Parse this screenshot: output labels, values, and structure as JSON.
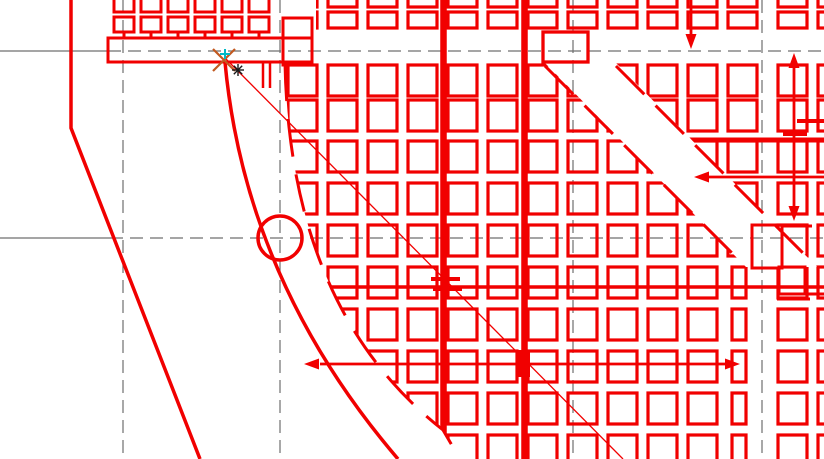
{
  "canvas": {
    "width": 824,
    "height": 459,
    "background": "#ffffff"
  },
  "colors": {
    "line_red": "#f10000",
    "construction_gray": "#6f6f6f",
    "snap_marker_orange": "#c2591f",
    "snap_cross_cyan": "#00b9c6",
    "point_marker_black": "#1a1a1a"
  },
  "construction_lines": {
    "dash": "13 7",
    "width": 1.2,
    "horizontal": [
      {
        "y": 51,
        "solid_from": 0,
        "solid_to": 108
      },
      {
        "y": 238,
        "solid_from": 0,
        "solid_to": 110
      }
    ],
    "vertical": [
      {
        "x": 123
      },
      {
        "x": 280
      },
      {
        "x": 573
      },
      {
        "x": 762
      }
    ]
  },
  "grid": {
    "stroke_width": 3.2,
    "cols_x": [
      288,
      328,
      368,
      408,
      448,
      488,
      528,
      568,
      608,
      648,
      688,
      728,
      778,
      818
    ],
    "rows_y": [
      65,
      100,
      141,
      183,
      225,
      267,
      309,
      351,
      393,
      435
    ],
    "cell_w": 29,
    "cell_h": 31,
    "flat_row": {
      "y": 12,
      "h": 16
    },
    "top_row": {
      "y": -20,
      "h": 27
    },
    "narrow_col": {
      "col_index": 11,
      "x": 732,
      "w": 14,
      "from_row_index": 5
    },
    "thick_verticals": [
      {
        "x": 443.5,
        "w": 6.5
      },
      {
        "x": 524.5,
        "w": 6.5
      }
    ],
    "clip_outer": "M 316,-25 L 316,63 L 285,63 Q 290,310 443,430 L 460,459 L 824,459 L 824,-25 Z",
    "clip_band": "M 545,63 L 616,63 L 817,267 L 746,267 Z"
  },
  "band_edges": {
    "dash": "40 16",
    "width": 3,
    "paths": [
      "M 545,66 L 740,261",
      "M 616,66 L 806,256"
    ]
  },
  "arc_boundary": {
    "path": "M 285,63 Q 290,310 443,430 L 460,459",
    "dash": "38 18",
    "width": 3
  },
  "curve_left": {
    "path": "M 225,62 Q 245,280 398,459",
    "width": 3.5
  },
  "edge_polyline": {
    "path": "M 71,0 L 71,128 L 200,459",
    "width": 3.5
  },
  "beam": {
    "outer_rect": [
      108,
      38,
      204,
      24
    ],
    "step_rect": [
      283,
      18,
      29,
      47
    ],
    "stroke_width": 3,
    "squares": {
      "xs": [
        114,
        141,
        168,
        195,
        222,
        249
      ],
      "y": 17,
      "w": 20,
      "h": 15
    },
    "stems": {
      "y1": 32,
      "y2": 38
    },
    "top_stubs": {
      "y": -8,
      "h": 20
    },
    "hang_lines": [
      [
        263,
        62,
        263,
        88
      ],
      [
        270,
        62,
        270,
        88
      ]
    ]
  },
  "column_rect": [
    543,
    32,
    45,
    30
  ],
  "overlay_lines": {
    "h287": {
      "x1": 290,
      "x2": 824,
      "y": 287,
      "width": 3.5,
      "hashes": [
        [
          431,
          277,
          29,
          4
        ],
        [
          433,
          287,
          29,
          4
        ]
      ]
    },
    "h140": {
      "x1": 688,
      "x2": 824,
      "y": 140,
      "width": 5,
      "hashes": [
        [
          783,
          131,
          24,
          5
        ]
      ],
      "extra": [
        797,
        121,
        824,
        121
      ]
    },
    "h299": [
      777,
      299,
      810,
      299
    ]
  },
  "step_detail": {
    "rects": [
      [
        752,
        225,
        30,
        43
      ],
      [
        779,
        267,
        26,
        27
      ]
    ],
    "lines": [
      [
        782,
        226,
        812,
        226
      ],
      [
        805,
        294,
        824,
        294
      ]
    ],
    "stroke_width": 3
  },
  "circle": {
    "cx": 280,
    "cy": 238,
    "r": 22,
    "width": 3.5
  },
  "diagonal_leader": {
    "x1": 225,
    "y1": 58,
    "x2": 623,
    "y2": 459,
    "width": 1.3,
    "blob": [
      517,
      350,
      13,
      27
    ]
  },
  "arrows": {
    "width": 2.8,
    "head_len": 15,
    "head_half": 5.5,
    "items": [
      {
        "name": "dim-arrow-horizontal",
        "line": [
          320,
          364,
          726,
          364
        ],
        "heads": [
          {
            "x": 304,
            "y": 364,
            "dir": "left"
          },
          {
            "x": 740,
            "y": 364,
            "dir": "right"
          }
        ]
      },
      {
        "name": "leader-arrow-left",
        "line": [
          708,
          177,
          824,
          177
        ],
        "heads": [
          {
            "x": 694,
            "y": 177,
            "dir": "left"
          }
        ]
      },
      {
        "name": "leader-arrow-down",
        "line": [
          691,
          0,
          691,
          38
        ],
        "heads": [
          {
            "x": 691,
            "y": 49,
            "dir": "down"
          }
        ]
      },
      {
        "name": "dim-arrow-vertical",
        "line": [
          794,
          64,
          794,
          210
        ],
        "heads": [
          {
            "x": 794,
            "y": 53,
            "dir": "up"
          },
          {
            "x": 794,
            "y": 221,
            "dir": "down"
          }
        ]
      }
    ]
  },
  "snap_markers": {
    "aperture_x": {
      "cx": 224,
      "cy": 60,
      "r": 11,
      "width": 2.2
    },
    "cross": {
      "cx": 225,
      "cy": 54,
      "r": 5,
      "width": 2
    },
    "star": {
      "cx": 238,
      "cy": 70,
      "r": 6,
      "width": 1.4
    }
  }
}
